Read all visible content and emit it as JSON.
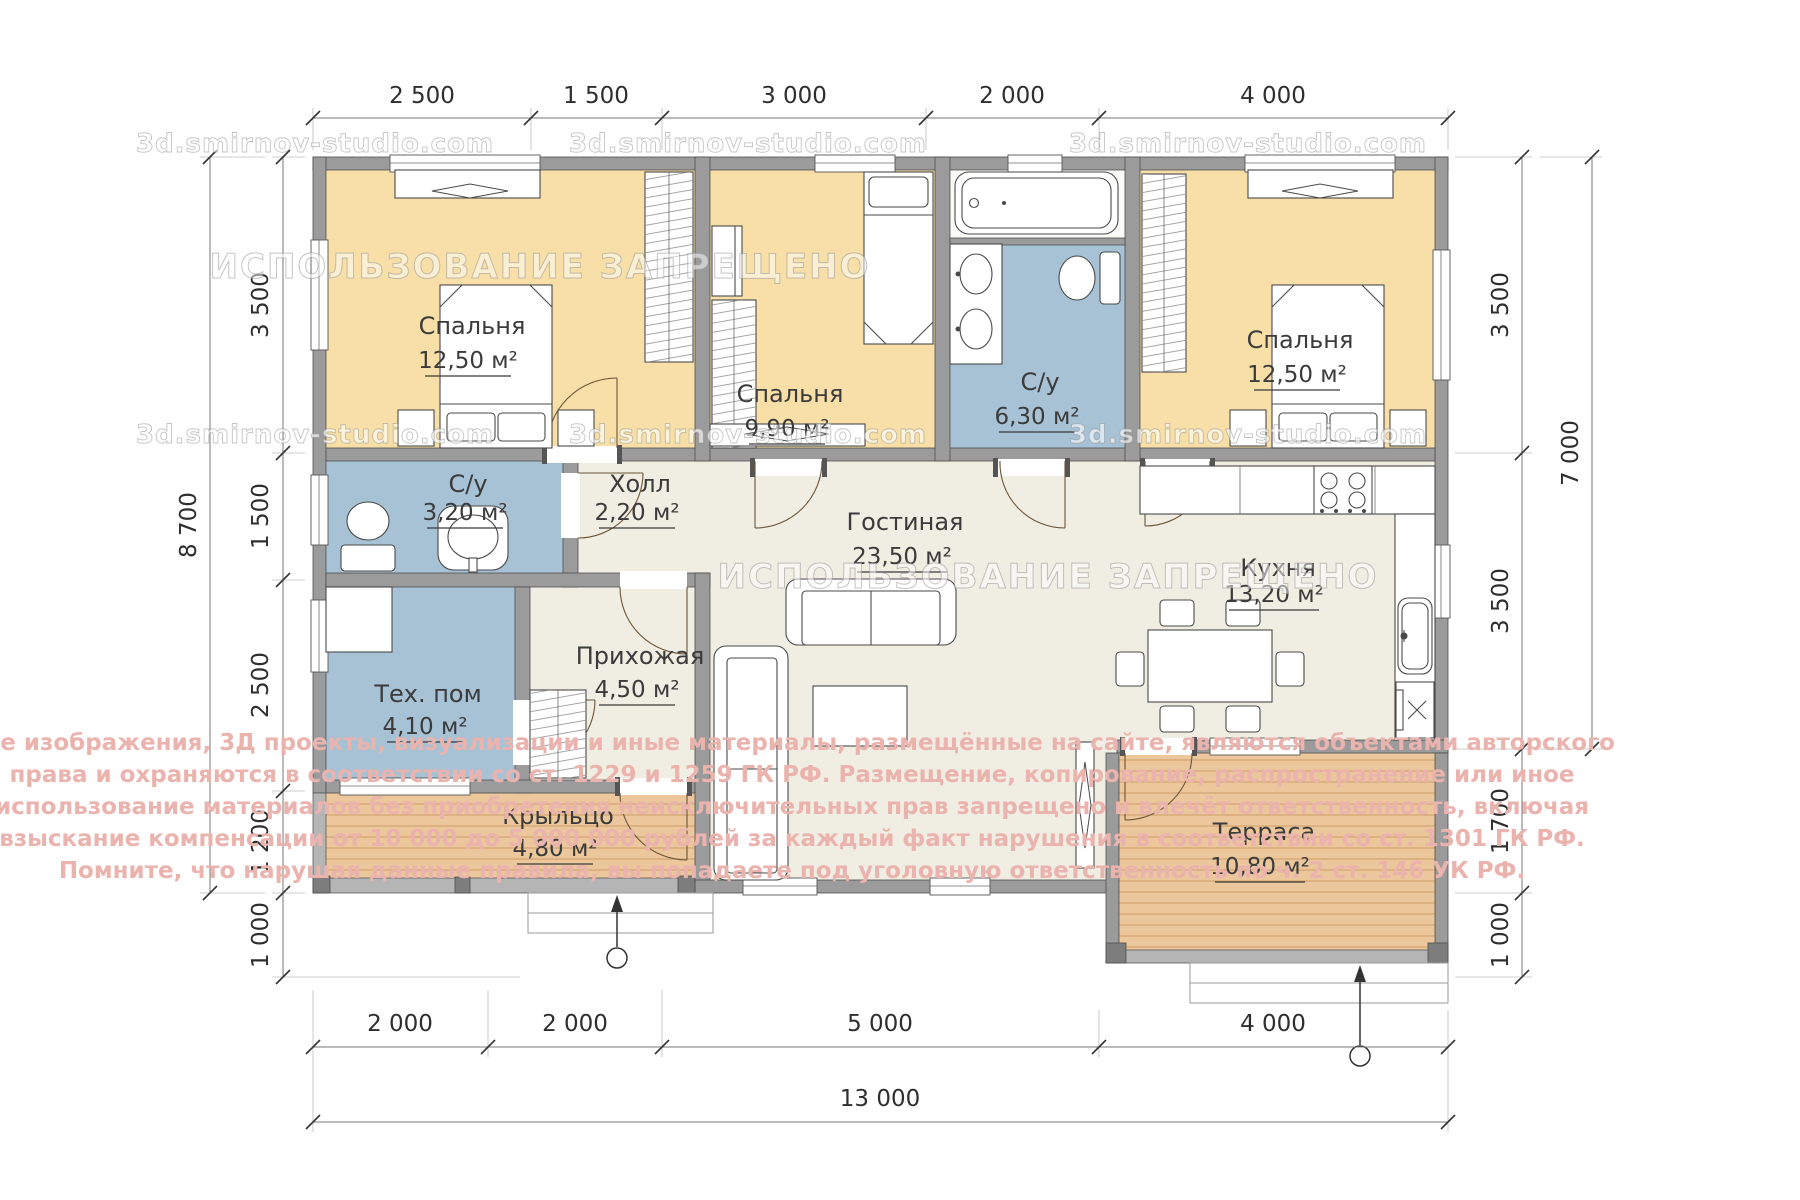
{
  "watermarks": {
    "site": "3d.smirnov-studio.com",
    "usage": "ИСПОЛЬЗОВАНИЕ ЗАПРЕЩЕНО",
    "copyright_lines": [
      "Все изображения, 3Д проекты, визуализации и иные материалы, размещённые на сайте, являются объектами авторского",
      "права и охраняются в соответствии со ст. 1229 и 1259 ГК РФ. Размещение, копирование, распространение или иное",
      "использование материалов без приобретения неисключительных прав запрещено и влечёт ответственность, включая",
      "взыскание компенсации от 10 000 до 5 000 000 рублей за каждый факт нарушения в соответствии со ст. 1301 ГК РФ.",
      "Помните, что нарушая данные правила, вы попадаете под уголовную ответственность по ч. 2 ст. 146 УК РФ."
    ]
  },
  "rooms": {
    "bedroom_left": {
      "name": "Спальня",
      "area": "12,50 м²"
    },
    "bedroom_middle": {
      "name": "Спальня",
      "area": "9,90 м²"
    },
    "bathroom_main": {
      "name": "С/у",
      "area": "6,30 м²"
    },
    "bedroom_right": {
      "name": "Спальня",
      "area": "12,50 м²"
    },
    "bathroom_small": {
      "name": "С/у",
      "area": "3,20 м²"
    },
    "hall": {
      "name": "Холл",
      "area": "2,20 м²"
    },
    "living": {
      "name": "Гостиная",
      "area": "23,50 м²"
    },
    "kitchen": {
      "name": "Кухня",
      "area": "13,20 м²"
    },
    "tech": {
      "name": "Тех. пом",
      "area": "4,10 м²"
    },
    "entry": {
      "name": "Прихожая",
      "area": "4,50 м²"
    },
    "porch": {
      "name": "Крыльцо",
      "area": "4,80 м²"
    },
    "terrace": {
      "name": "Терраса",
      "area": "10,80 м²"
    }
  },
  "dimensions": {
    "top": [
      "2 500",
      "1 500",
      "3 000",
      "2 000",
      "4 000"
    ],
    "left": [
      "3 500",
      "1 500",
      "2 500",
      "1 200",
      "1 000"
    ],
    "left_total": "8 700",
    "right": [
      "3 500",
      "3 500",
      "1 700",
      "1 000"
    ],
    "right_total": "7 000",
    "bottom": [
      "2 000",
      "2 000",
      "5 000",
      "4 000"
    ],
    "bottom_total": "13 000"
  },
  "colors": {
    "bedroom_floor": "#F7DFA7",
    "wet_floor": "#A7C1D5",
    "living_floor": "#F0EDE2",
    "wood_floor": "#EBC79B",
    "wall": "#9B9B9B",
    "copyright_text": "#EBB3AD"
  }
}
